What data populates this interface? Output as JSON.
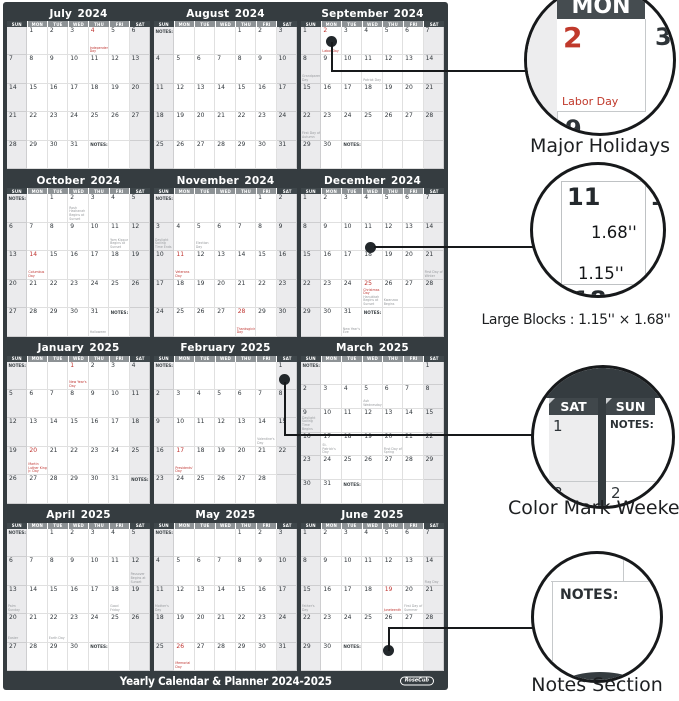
{
  "labels": {
    "notes": "NOTES:"
  },
  "colors": {
    "poster_dark": "#353c40",
    "weekday_header_gray": "#8d9295",
    "weekend_header_dark": "#3f474b",
    "weekend_cell": "#ebebed",
    "holiday_red": "#bf3430"
  },
  "day_headers": [
    "SUN",
    "MON",
    "TUE",
    "WED",
    "THU",
    "FRI",
    "SAT"
  ],
  "months": [
    {
      "name": "July",
      "year": "2024",
      "weeks": [
        [
          null,
          1,
          2,
          3,
          {
            "d": 4,
            "r": 1,
            "s": "Independence Day",
            "sr": 1
          },
          5,
          6
        ],
        [
          7,
          8,
          9,
          10,
          11,
          12,
          13
        ],
        [
          14,
          15,
          16,
          17,
          18,
          19,
          20
        ],
        [
          21,
          22,
          23,
          24,
          25,
          26,
          27
        ],
        [
          28,
          29,
          30,
          31,
          {
            "n": 1
          },
          null,
          null
        ]
      ]
    },
    {
      "name": "August",
      "year": "2024",
      "weeks": [
        [
          {
            "n": 1
          },
          null,
          null,
          null,
          1,
          2,
          3
        ],
        [
          4,
          5,
          6,
          7,
          8,
          9,
          10
        ],
        [
          11,
          12,
          13,
          14,
          15,
          16,
          17
        ],
        [
          18,
          19,
          20,
          21,
          22,
          23,
          24
        ],
        [
          25,
          26,
          27,
          28,
          29,
          30,
          31
        ]
      ]
    },
    {
      "name": "September",
      "year": "2024",
      "weeks": [
        [
          1,
          {
            "d": 2,
            "r": 1,
            "s": "Labor Day",
            "sr": 1
          },
          3,
          4,
          5,
          6,
          7
        ],
        [
          {
            "d": 8,
            "s": "Grandparents Day"
          },
          9,
          10,
          {
            "d": 11,
            "s": "Patriot Day"
          },
          12,
          13,
          14
        ],
        [
          15,
          16,
          17,
          18,
          19,
          20,
          21
        ],
        [
          {
            "d": 22,
            "s": "First Day of Autumn"
          },
          23,
          24,
          25,
          26,
          27,
          28
        ],
        [
          29,
          30,
          {
            "n": 1
          },
          null,
          null,
          null,
          null
        ]
      ]
    },
    {
      "name": "October",
      "year": "2024",
      "weeks": [
        [
          {
            "n": 1
          },
          null,
          1,
          {
            "d": 2,
            "s": "Rosh Hashanah Begins at Sunset"
          },
          3,
          4,
          5
        ],
        [
          6,
          7,
          8,
          9,
          10,
          {
            "d": 11,
            "s": "Yom Kippur Begins at Sunset"
          },
          12
        ],
        [
          13,
          {
            "d": 14,
            "r": 1,
            "s": "Columbus Day",
            "sr": 1
          },
          15,
          16,
          17,
          18,
          19
        ],
        [
          20,
          21,
          22,
          23,
          24,
          25,
          26
        ],
        [
          27,
          28,
          29,
          30,
          {
            "d": 31,
            "s": "Halloween"
          },
          {
            "n": 1
          },
          null
        ]
      ]
    },
    {
      "name": "November",
      "year": "2024",
      "weeks": [
        [
          {
            "n": 1
          },
          null,
          null,
          null,
          null,
          1,
          2
        ],
        [
          {
            "d": 3,
            "s": "Daylight Saving Time Ends"
          },
          4,
          {
            "d": 5,
            "s": "Election Day"
          },
          6,
          7,
          8,
          9
        ],
        [
          10,
          {
            "d": 11,
            "r": 1,
            "s": "Veterans Day",
            "sr": 1
          },
          12,
          13,
          14,
          15,
          16
        ],
        [
          17,
          18,
          19,
          20,
          21,
          22,
          23
        ],
        [
          24,
          25,
          26,
          27,
          {
            "d": 28,
            "r": 1,
            "s": "Thanksgiving Day",
            "sr": 1
          },
          29,
          30
        ]
      ]
    },
    {
      "name": "December",
      "year": "2024",
      "weeks": [
        [
          1,
          2,
          3,
          4,
          5,
          6,
          7
        ],
        [
          8,
          9,
          10,
          11,
          12,
          13,
          14
        ],
        [
          15,
          16,
          17,
          18,
          19,
          20,
          {
            "d": 21,
            "s": "First Day of Winter"
          }
        ],
        [
          22,
          23,
          24,
          {
            "d": 25,
            "r": 1,
            "s": "Christmas Day",
            "sr": 1,
            "s2": "Hanukkah Begins at Sunset"
          },
          {
            "d": 26,
            "s": "Kwanzaa Begins"
          },
          27,
          28
        ],
        [
          29,
          30,
          {
            "d": 31,
            "s": "New Year's Eve"
          },
          {
            "n": 1
          },
          null,
          null,
          null
        ]
      ]
    },
    {
      "name": "January",
      "year": "2025",
      "weeks": [
        [
          {
            "n": 1
          },
          null,
          null,
          {
            "d": 1,
            "r": 1,
            "s": "New Year's Day",
            "sr": 1
          },
          2,
          3,
          4
        ],
        [
          5,
          6,
          7,
          8,
          9,
          10,
          11
        ],
        [
          12,
          13,
          14,
          15,
          16,
          17,
          18
        ],
        [
          19,
          {
            "d": 20,
            "r": 1,
            "s": "Martin Luther King Jr. Day",
            "sr": 1
          },
          21,
          22,
          23,
          24,
          25
        ],
        [
          26,
          27,
          28,
          29,
          30,
          31,
          {
            "n": 1
          }
        ]
      ]
    },
    {
      "name": "February",
      "year": "2025",
      "weeks": [
        [
          {
            "n": 1
          },
          null,
          null,
          null,
          null,
          null,
          1
        ],
        [
          2,
          3,
          4,
          5,
          6,
          7,
          8
        ],
        [
          9,
          10,
          11,
          12,
          13,
          {
            "d": 14,
            "s": "Valentine's Day"
          },
          15
        ],
        [
          16,
          {
            "d": 17,
            "r": 1,
            "s": "Presidents' Day",
            "sr": 1
          },
          18,
          19,
          20,
          21,
          22
        ],
        [
          23,
          24,
          25,
          26,
          27,
          28,
          null
        ]
      ]
    },
    {
      "name": "March",
      "year": "2025",
      "weeks": [
        [
          {
            "n": 1
          },
          null,
          null,
          null,
          null,
          null,
          1
        ],
        [
          2,
          3,
          4,
          {
            "d": 5,
            "s": "Ash Wednesday"
          },
          6,
          7,
          8
        ],
        [
          {
            "d": 9,
            "s": "Daylight Saving Time Begins"
          },
          10,
          11,
          12,
          13,
          14,
          15
        ],
        [
          16,
          {
            "d": 17,
            "s": "St. Patrick's Day"
          },
          18,
          19,
          {
            "d": 20,
            "s": "First Day of Spring"
          },
          21,
          22
        ],
        [
          23,
          24,
          25,
          26,
          27,
          28,
          29
        ],
        [
          30,
          31,
          {
            "n": 1
          },
          null,
          null,
          null,
          null
        ]
      ]
    },
    {
      "name": "April",
      "year": "2025",
      "weeks": [
        [
          {
            "n": 1
          },
          null,
          1,
          2,
          3,
          4,
          5
        ],
        [
          6,
          7,
          8,
          9,
          10,
          11,
          {
            "d": 12,
            "s": "Passover Begins at Sunset"
          }
        ],
        [
          {
            "d": 13,
            "s": "Palm Sunday"
          },
          14,
          15,
          16,
          17,
          {
            "d": 18,
            "s": "Good Friday"
          },
          19
        ],
        [
          {
            "d": 20,
            "s": "Easter"
          },
          21,
          {
            "d": 22,
            "s": "Earth Day"
          },
          23,
          24,
          25,
          26
        ],
        [
          27,
          28,
          29,
          30,
          {
            "n": 1
          },
          null,
          null
        ]
      ]
    },
    {
      "name": "May",
      "year": "2025",
      "weeks": [
        [
          {
            "n": 1
          },
          null,
          null,
          null,
          1,
          2,
          3
        ],
        [
          4,
          5,
          6,
          7,
          8,
          9,
          10
        ],
        [
          {
            "d": 11,
            "s": "Mother's Day"
          },
          12,
          13,
          14,
          15,
          16,
          17
        ],
        [
          18,
          19,
          20,
          21,
          22,
          23,
          24
        ],
        [
          25,
          {
            "d": 26,
            "r": 1,
            "s": "Memorial Day",
            "sr": 1
          },
          27,
          28,
          29,
          30,
          31
        ]
      ]
    },
    {
      "name": "June",
      "year": "2025",
      "weeks": [
        [
          1,
          2,
          3,
          4,
          5,
          6,
          7
        ],
        [
          8,
          9,
          10,
          11,
          12,
          13,
          {
            "d": 14,
            "s": "Flag Day"
          }
        ],
        [
          {
            "d": 15,
            "s": "Father's Day"
          },
          16,
          17,
          18,
          {
            "d": 19,
            "r": 1,
            "s": "Juneteenth",
            "sr": 1
          },
          {
            "d": 20,
            "s": "First Day of Summer"
          },
          21
        ],
        [
          22,
          23,
          24,
          25,
          26,
          27,
          28
        ],
        [
          29,
          30,
          {
            "n": 1
          },
          null,
          null,
          null,
          null
        ]
      ]
    }
  ],
  "footer": {
    "title": "Yearly Calendar & Planner 2024-2025",
    "brand": "RoseCub"
  },
  "callouts": [
    {
      "caption": "Major Holidays",
      "zoom": {
        "header": "MON",
        "day": "2",
        "holiday": "Labor Day",
        "neighbor_day": "3",
        "below_day": "9"
      }
    },
    {
      "caption": "Large Blocks :  1.15'' × 1.68''",
      "zoom": {
        "day": "11",
        "neighbor_day": "12",
        "height_label": "1.68''",
        "width_label": "1.15''",
        "below_day": "18"
      }
    },
    {
      "caption": "Color Mark Weekend",
      "zoom": {
        "sat_header": "SAT",
        "sun_header": "SUN",
        "sat_day_top": "1",
        "sat_day_bottom": "8",
        "sun_notes": "NOTES:",
        "sun_day_bottom": "2"
      }
    },
    {
      "caption": "Notes Section",
      "zoom": {
        "notes_label": "NOTES:"
      }
    }
  ]
}
